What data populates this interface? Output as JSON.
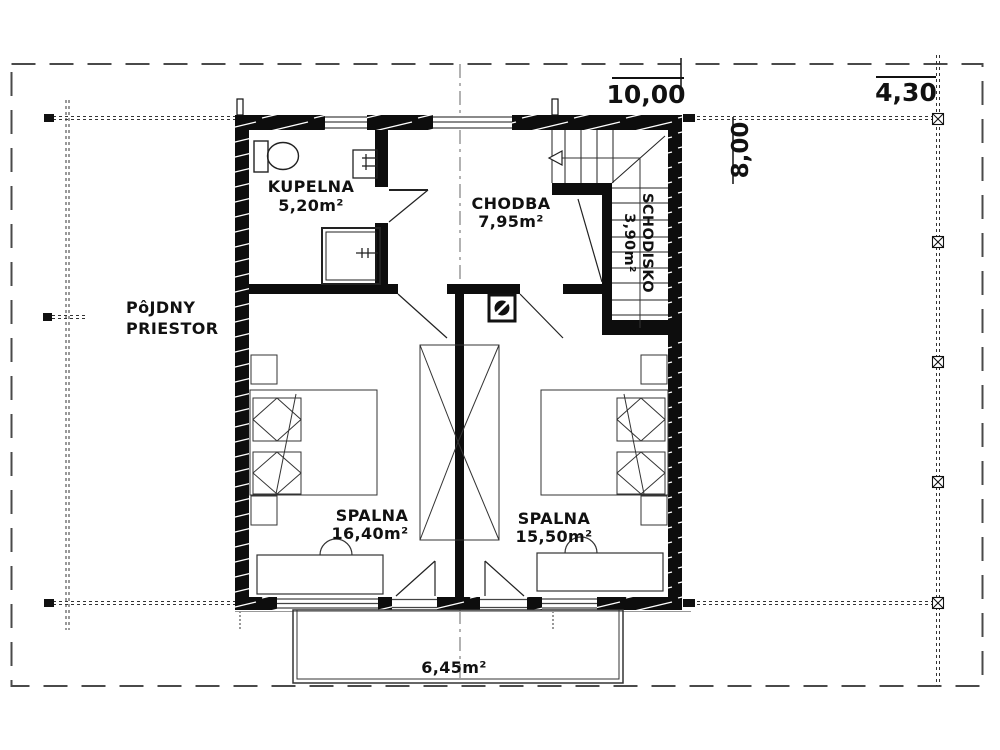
{
  "plan": {
    "rooms": {
      "kupelna": {
        "name": "KUPELNA",
        "area": "5,20m²"
      },
      "chodba": {
        "name": "CHODBA",
        "area": "7,95m²"
      },
      "schodisko": {
        "name": "SCHODISKO",
        "area": "3,90m²"
      },
      "attic": {
        "name_line1": "PôJDNY",
        "name_line2": "PRIESTOR"
      },
      "bedroom_left": {
        "name": "SPALNA",
        "area": "16,40m²"
      },
      "bedroom_right": {
        "name": "SPALNA",
        "area": "15,50m²"
      },
      "balcony": {
        "name": "BALKON",
        "area": "6,45m²"
      }
    },
    "dimensions": {
      "overall_width": "10,00",
      "right_offset": "4,30",
      "depth": "8,00"
    }
  }
}
